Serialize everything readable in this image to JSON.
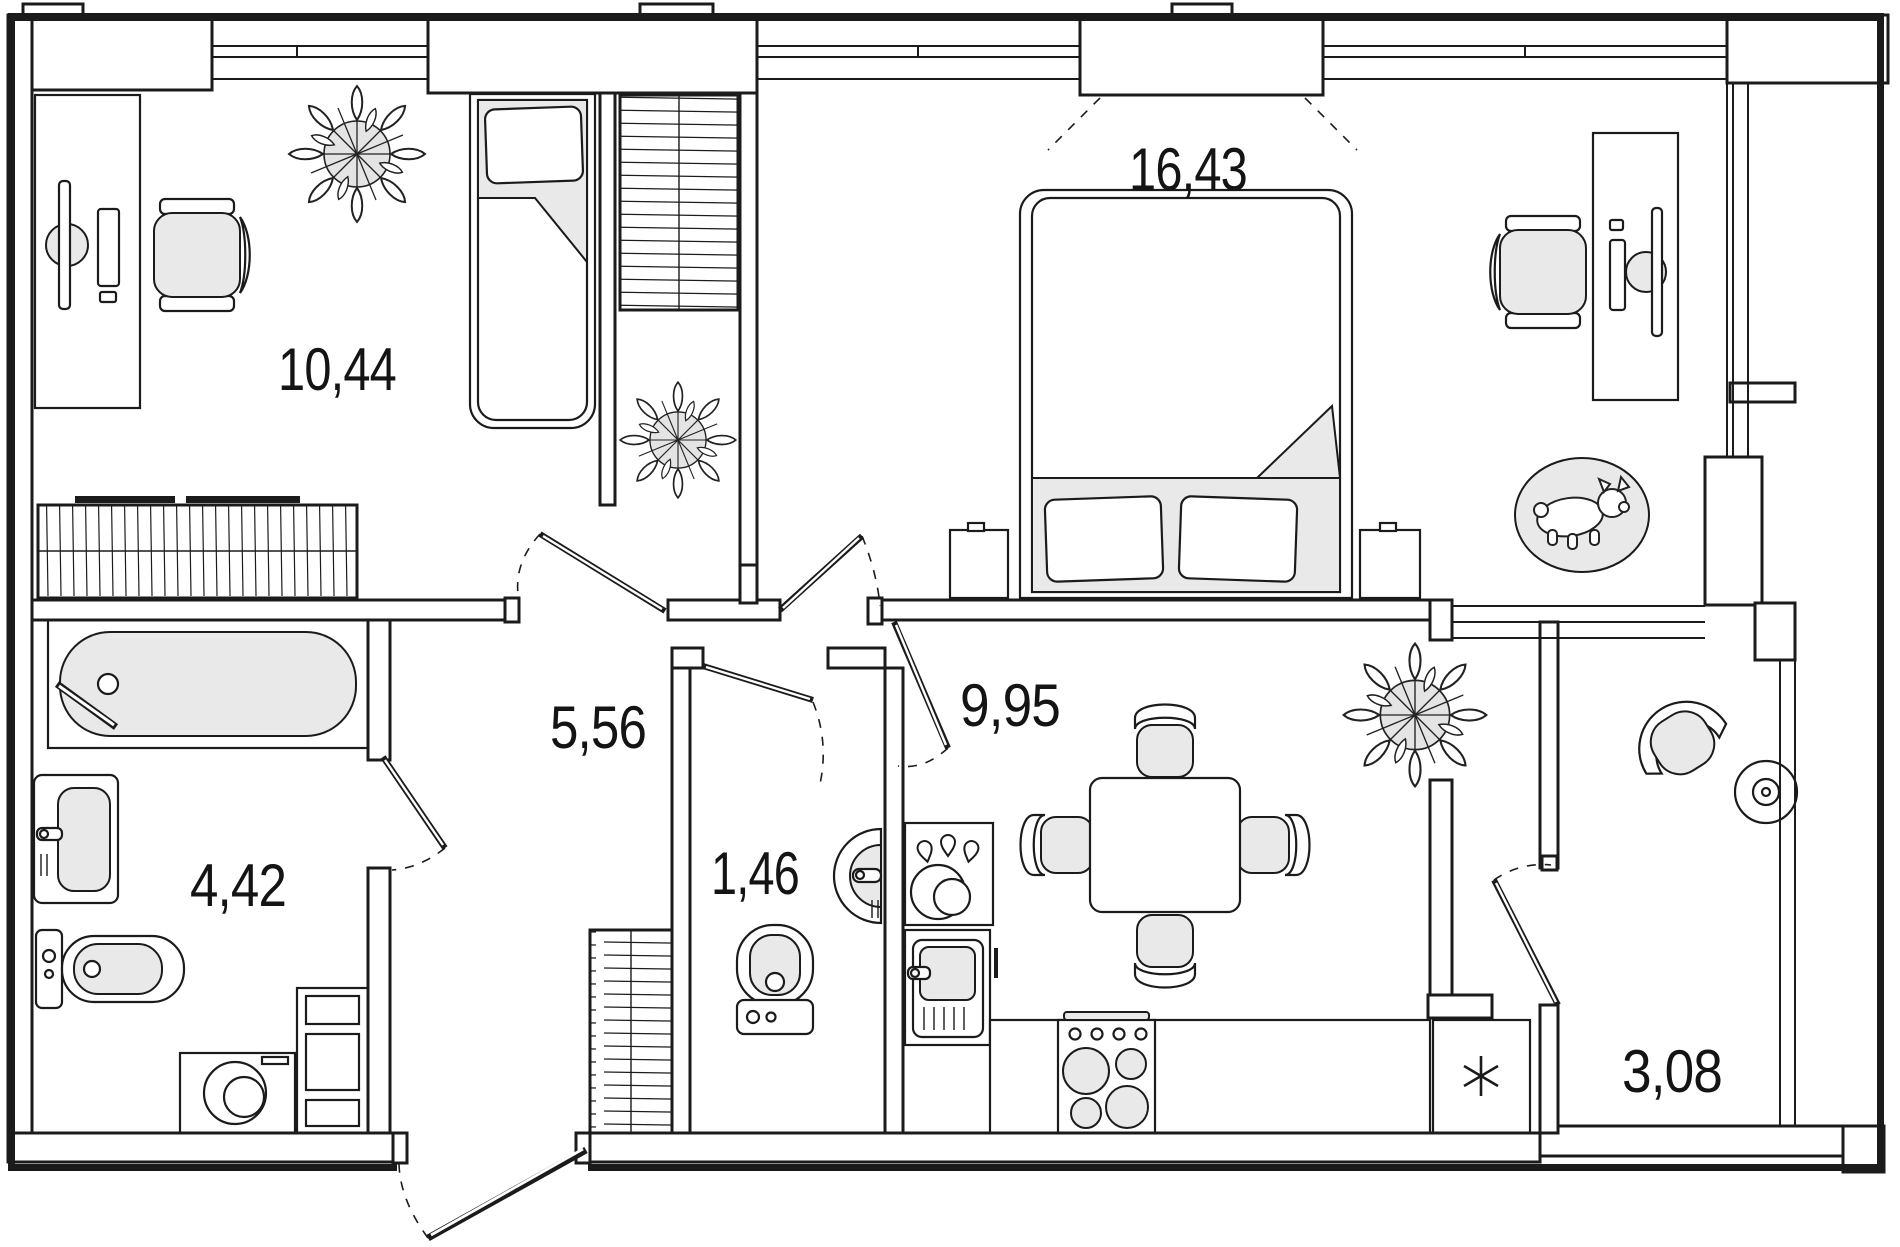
{
  "rooms": [
    {
      "key": "bedroom",
      "area": "10,44"
    },
    {
      "key": "master_bedroom",
      "area": "16,43"
    },
    {
      "key": "hallway",
      "area": "5,56"
    },
    {
      "key": "kitchen_living",
      "area": "9,95"
    },
    {
      "key": "bathroom",
      "area": "4,42"
    },
    {
      "key": "wc",
      "area": "1,46"
    },
    {
      "key": "loggia",
      "area": "3,08"
    }
  ],
  "colors": {
    "line": "#1b1b1b",
    "furniture_fill": "#e9e9e9",
    "wall_fill": "#ffffff",
    "background": "#ffffff"
  },
  "icons": {
    "fridge_marker": "six-point-asterisk",
    "rug_motif": "corgi-dog",
    "plant": "flowering-pot-plant"
  }
}
